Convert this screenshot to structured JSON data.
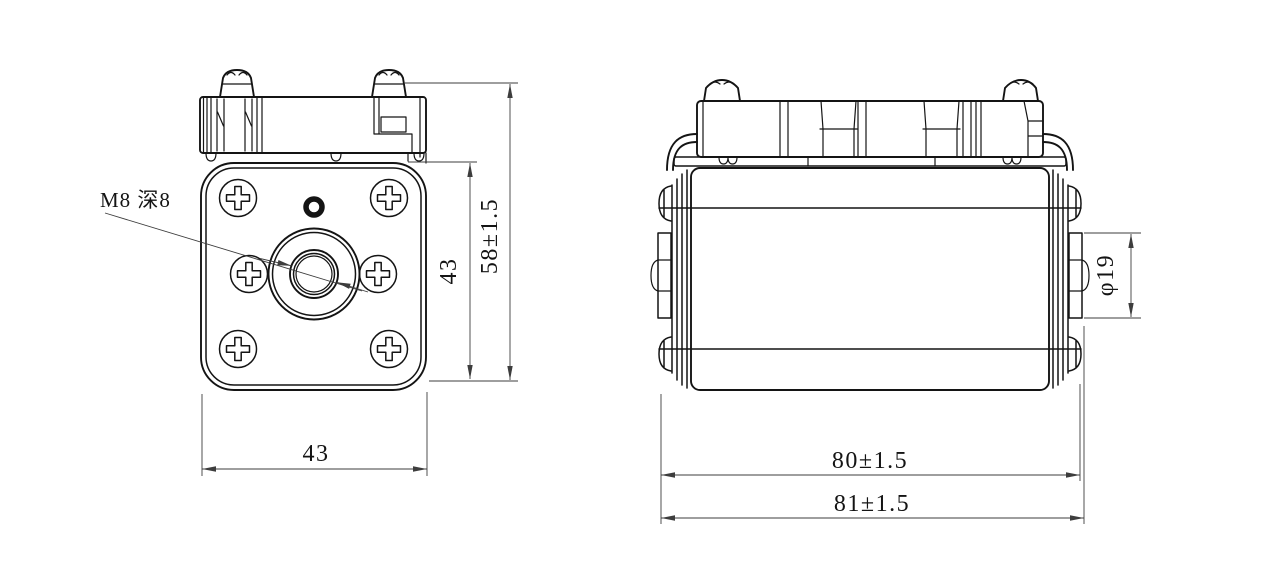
{
  "drawing": {
    "background_color": "#ffffff",
    "line_color": "#141414",
    "dim_color": "#3d3d3d",
    "front_view": {
      "name": "front-view",
      "thread_callout": "M8 深8",
      "width_dim": "43",
      "height_dim": "43",
      "overall_height_dim": "58±1.5"
    },
    "side_view": {
      "name": "side-view",
      "terminal_diameter_dim": "φ19",
      "body_length_dim": "80±1.5",
      "overall_length_dim": "81±1.5"
    }
  }
}
